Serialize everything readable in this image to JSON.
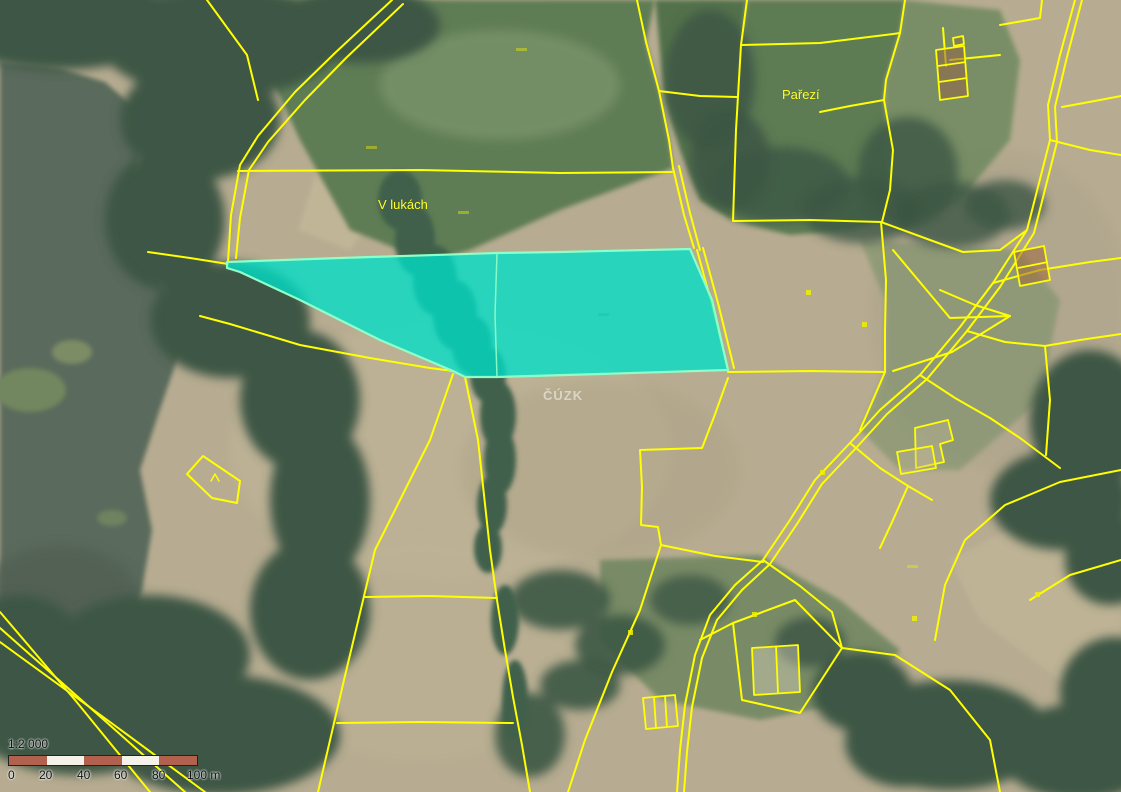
{
  "labels": {
    "settlement": "Pařezí",
    "locality": "V lukách"
  },
  "watermark": "ČÚZK",
  "scalebar": {
    "ratio": "1:2 000",
    "ticks": [
      "0",
      "20",
      "40",
      "60",
      "80",
      "100 m"
    ]
  },
  "highlight": {
    "subparcel_count": 2,
    "fill": "#00dfc8",
    "border": "#8effc9"
  },
  "colors": {
    "parcel_line": "#ffff00",
    "scalebar_red": "#b2614e",
    "scalebar_white": "#f5f2ea"
  }
}
